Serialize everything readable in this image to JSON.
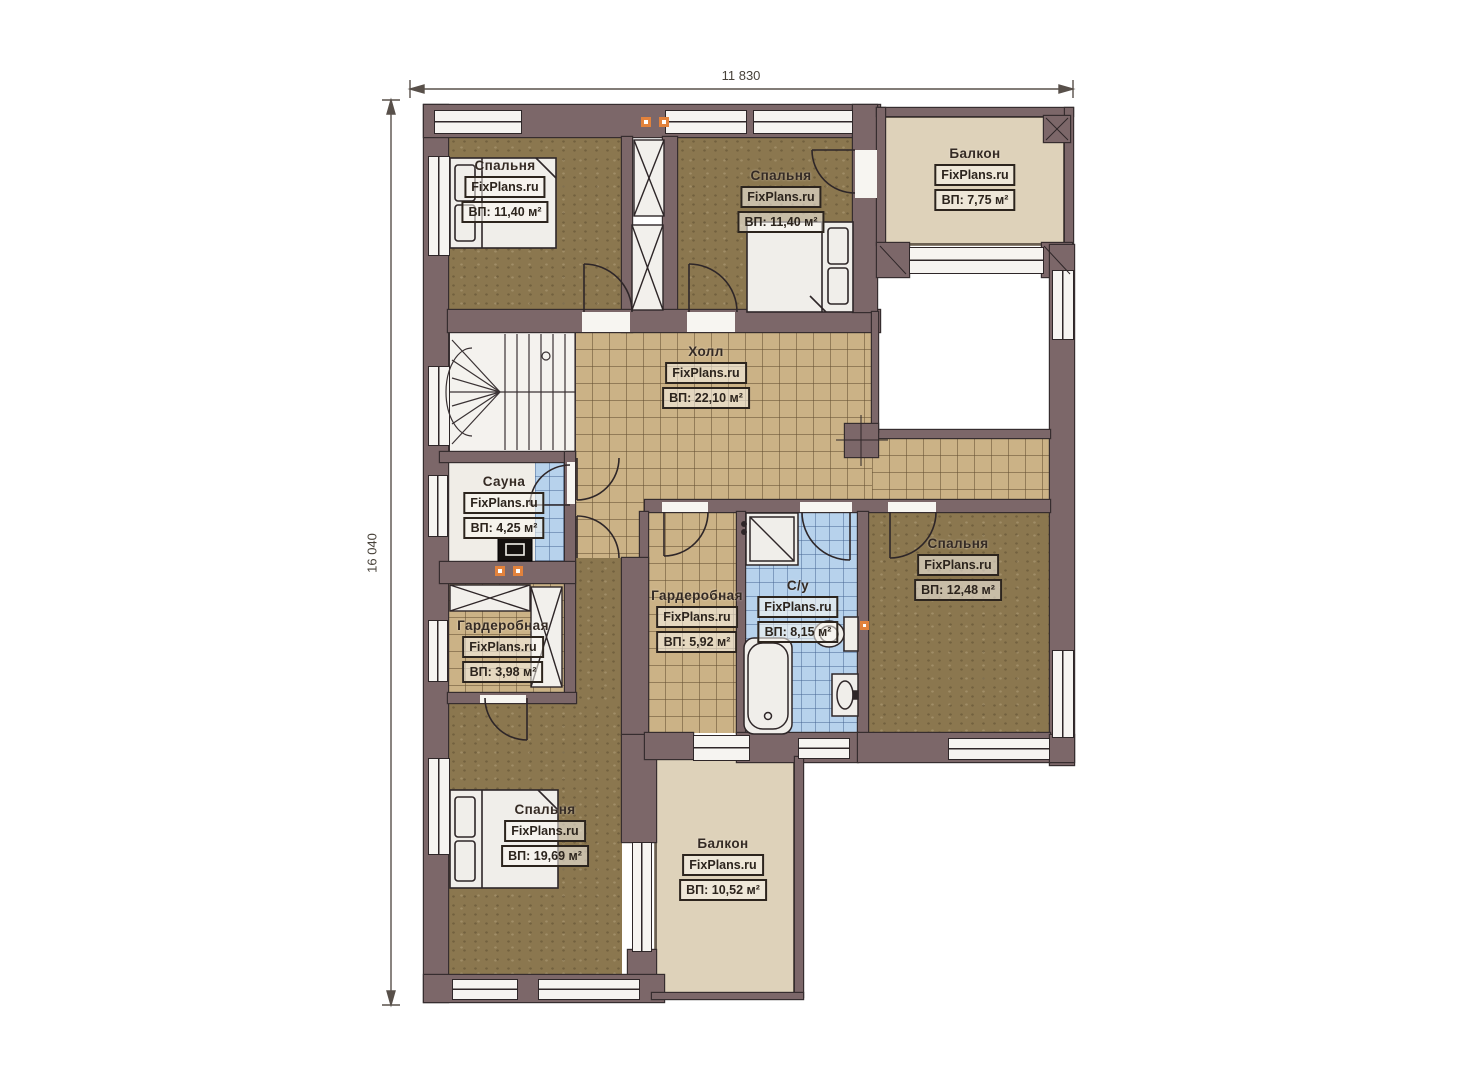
{
  "plan": {
    "title": "floor-plan-second-storey",
    "dimensions": {
      "width_mm": "11 830",
      "height_mm": "16 040"
    },
    "watermark": "FixPlans.ru",
    "rooms": [
      {
        "key": "bedroom_top_left",
        "name": "Спальня",
        "watermark": "FixPlans.ru",
        "area": "ВП: 11,40 м²"
      },
      {
        "key": "bedroom_top_mid",
        "name": "Спальня",
        "watermark": "FixPlans.ru",
        "area": "ВП: 11,40 м²"
      },
      {
        "key": "balcony_top_right",
        "name": "Балкон",
        "watermark": "FixPlans.ru",
        "area": "ВП: 7,75 м²"
      },
      {
        "key": "hall",
        "name": "Холл",
        "watermark": "FixPlans.ru",
        "area": "ВП: 22,10 м²"
      },
      {
        "key": "sauna",
        "name": "Сауна",
        "watermark": "FixPlans.ru",
        "area": "ВП: 4,25 м²"
      },
      {
        "key": "wardrobe_small",
        "name": "Гардеробная",
        "watermark": "FixPlans.ru",
        "area": "ВП: 3,98 м²"
      },
      {
        "key": "wardrobe_mid",
        "name": "Гардеробная",
        "watermark": "FixPlans.ru",
        "area": "ВП: 5,92 м²"
      },
      {
        "key": "bathroom",
        "name": "С/у",
        "watermark": "FixPlans.ru",
        "area": "ВП: 8,15 м²"
      },
      {
        "key": "bedroom_right",
        "name": "Спальня",
        "watermark": "FixPlans.ru",
        "area": "ВП: 12,48 м²"
      },
      {
        "key": "bedroom_bottom_left",
        "name": "Спальня",
        "watermark": "FixPlans.ru",
        "area": "ВП: 19,69 м²"
      },
      {
        "key": "balcony_bottom",
        "name": "Балкон",
        "watermark": "FixPlans.ru",
        "area": "ВП: 10,52 м²"
      }
    ],
    "colors": {
      "wall": "#7c6769",
      "carpet": "#8b774f",
      "tile_tan": "#cbb286",
      "tile_blue": "#b7d2ec",
      "balcony_floor": "#ded2ba",
      "marker": "#e2823c"
    }
  }
}
